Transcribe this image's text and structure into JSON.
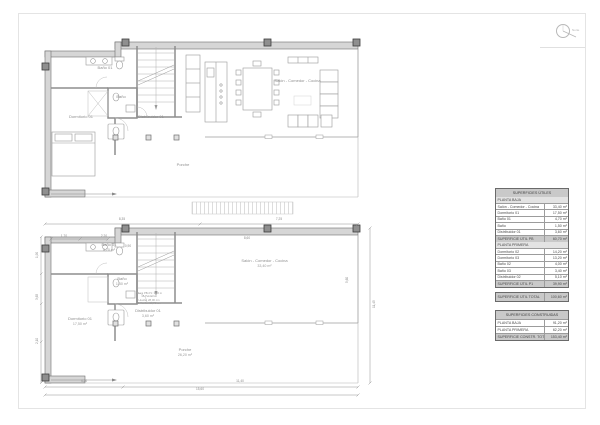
{
  "sheet": {
    "north_label": "Norte"
  },
  "plan_furnished": {
    "rooms": {
      "bano01": "Baño 01",
      "bano": "Baño",
      "dormitorio01": "Dormitorio 01",
      "distribuidor01": "Distribuidor 01",
      "salon": "Salón - Comedor - Cocina",
      "porche": "Porche"
    }
  },
  "plan_dimensioned": {
    "rooms": {
      "bano01": {
        "label": "Baño 01",
        "area": "4,70 m²"
      },
      "bano": {
        "label": "Baño",
        "area": "1,50 m²"
      },
      "dormitorio01": {
        "label": "Dormitorio 01",
        "area": "17,50 m²"
      },
      "distribuidor01": {
        "label": "Distribuidor 01",
        "area": "3,60 m²"
      },
      "salon": {
        "label": "Salón - Comedor - Cocina",
        "area": "33,40 m²"
      },
      "porche": {
        "label": "Porche",
        "area": "26,20 m²"
      }
    },
    "stair_note": {
      "l1": "Altura PB-P1: 3,00 m",
      "l2": "16 Peldaños",
      "l3": "Huella: 28,00 cm",
      "l4": "C.Huella: 18,75 cm"
    },
    "dims": {
      "top_left": "8,35",
      "top_right": "7,25",
      "bottom_left": "4,20",
      "bottom_right": "11,40",
      "bottom_total": "15,60",
      "right_total": "11,45",
      "left1": "1,90",
      "left2": "3,65",
      "left3": "2,10",
      "in1": "1,70",
      "in2": "2,20",
      "in3": "0,90",
      "salon_w": "8,60",
      "salon_h": "5,60"
    }
  },
  "tables": {
    "utiles": {
      "title": "SUPERFICIES ÚTILES",
      "pb": {
        "name": "PLANTA BAJA",
        "rows": [
          {
            "label": "Salón - Comedor - Cocina",
            "value": "33,40 m²"
          },
          {
            "label": "Dormitorio 01",
            "value": "17,50 m²"
          },
          {
            "label": "Baño 01",
            "value": "4,70 m²"
          },
          {
            "label": "Baño",
            "value": "1,50 m²"
          },
          {
            "label": "Distribuidor 01",
            "value": "3,60 m²"
          }
        ],
        "total_label": "SUPERFICIE ÚTIL PB",
        "total_value": "60,70 m²"
      },
      "p1": {
        "name": "PLANTA PRIMERA",
        "rows": [
          {
            "label": "Dormitorio 02",
            "value": "14,20 m²"
          },
          {
            "label": "Dormitorio 03",
            "value": "13,20 m²"
          },
          {
            "label": "Baño 02",
            "value": "4,00 m²"
          },
          {
            "label": "Baño 03",
            "value": "3,40 m²"
          },
          {
            "label": "Distribuidor 02",
            "value": "5,10 m²"
          }
        ],
        "total_label": "SUPERFICIE ÚTIL P1",
        "total_value": "39,90 m²"
      },
      "total_label": "SUPERFICIE ÚTIL TOTAL",
      "total_value": "100,60 m²"
    },
    "construidas": {
      "title": "SUPERFICIES CONSTRUIDAS",
      "rows": [
        {
          "label": "PLANTA BAJA",
          "value": "91,20 m²"
        },
        {
          "label": "PLANTA PRIMERA",
          "value": "62,20 m²"
        }
      ],
      "total_label": "SUPERFICIE CONSTR. TOTAL",
      "total_value": "153,40 m²"
    }
  }
}
